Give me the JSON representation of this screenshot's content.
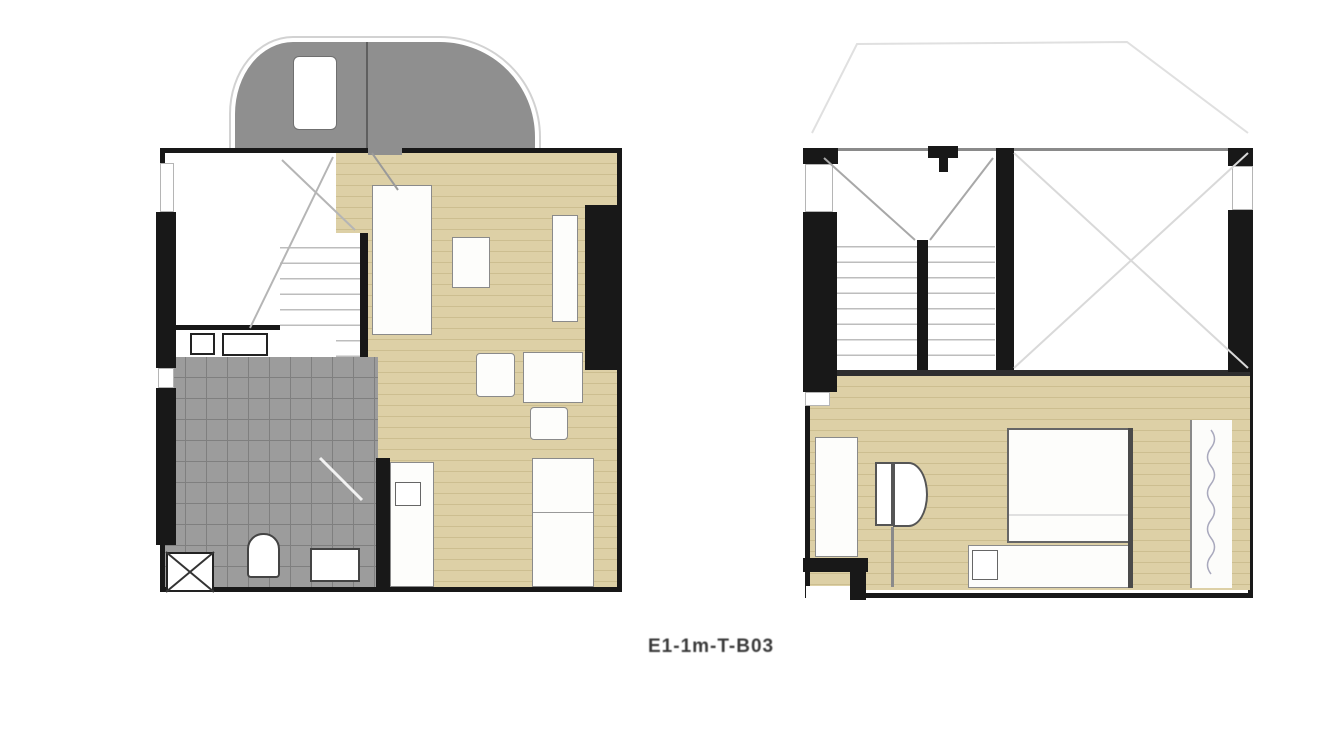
{
  "caption": {
    "label": "E1-1m-T-B03"
  },
  "colors": {
    "background": "#ffffff",
    "wall": "#181818",
    "wood_floor": "#ddd0a6",
    "wood_stripe": "#ccbe90",
    "tile_floor": "#9c9c9c",
    "terrace": "#8f8f8f",
    "void_cross_line": "#d9d9d9",
    "roof_outline": "#e0e0e0"
  },
  "plans": {
    "lower": {
      "title": "lower-floor-unit-plan"
    },
    "upper": {
      "title": "upper-floor-unit-plan"
    }
  }
}
